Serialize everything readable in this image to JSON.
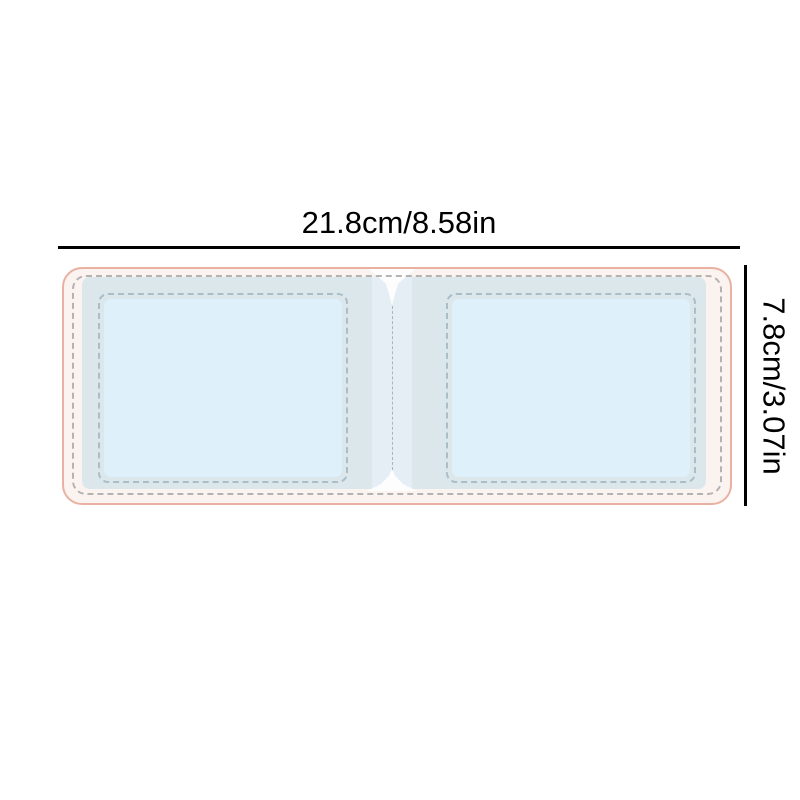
{
  "dimensions": {
    "width_label": "21.8cm/8.58in",
    "height_label": "7.8cm/3.07in"
  },
  "colors": {
    "background": "#ffffff",
    "dimension_ink": "#000000",
    "shell_fill": "#faf3ef",
    "shell_border": "#e9b1a2",
    "outer_stitch": "#a9a9a7",
    "panel_blue": "#dbe7eb",
    "center_panel": "#e4eef4",
    "pocket_blue": "#def0fa",
    "inner_stitch": "#9fb4bf",
    "center_stitch": "#a3b7c1",
    "notch_white": "#fdfdfd"
  }
}
